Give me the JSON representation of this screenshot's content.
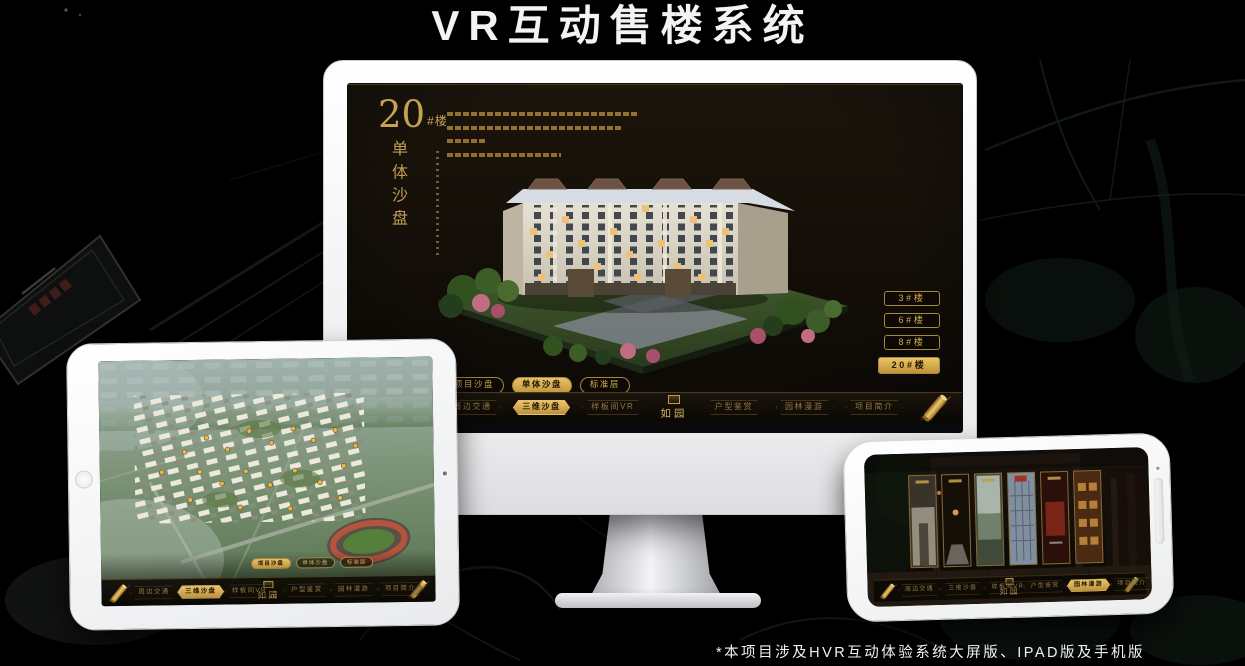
{
  "page": {
    "title": "VR互动售楼系统",
    "footnote": "*本项目涉及HVR互动体验系统大屏版、IPAD版及手机版"
  },
  "colors": {
    "gold": "#d2a94e",
    "gold_active": "#e9c268",
    "screen_background": "#171108",
    "device_white": "#ffffff"
  },
  "monitor": {
    "hero": {
      "number": "20",
      "suffix": "#楼",
      "subtitle": "单体沙盘"
    },
    "floor_buttons": [
      {
        "label": "3#楼",
        "active": false
      },
      {
        "label": "6#楼",
        "active": false
      },
      {
        "label": "8#楼",
        "active": false
      },
      {
        "label": "20#楼",
        "active": true
      }
    ],
    "tabs": [
      {
        "label": "项目沙盘",
        "active": false
      },
      {
        "label": "单体沙盘",
        "active": true
      },
      {
        "label": "标准层",
        "active": false
      }
    ],
    "nav": {
      "left": [
        {
          "label": "周边交通",
          "active": false
        },
        {
          "label": "三维沙盘",
          "active": true
        },
        {
          "label": "样板间VR",
          "active": false
        }
      ],
      "logo": "如园",
      "right": [
        {
          "label": "户型鉴赏",
          "active": false
        },
        {
          "label": "园林漫游",
          "active": false
        },
        {
          "label": "项目简介",
          "active": false
        }
      ]
    }
  },
  "tablet": {
    "tabs": [
      {
        "label": "项目沙盘",
        "active": true
      },
      {
        "label": "单体沙盘",
        "active": false
      },
      {
        "label": "标准层",
        "active": false
      }
    ],
    "nav": {
      "left": [
        {
          "label": "周边交通",
          "active": false
        },
        {
          "label": "三维沙盘",
          "active": true
        },
        {
          "label": "样板间VR",
          "active": false
        }
      ],
      "logo": "如园",
      "right": [
        {
          "label": "户型鉴赏",
          "active": false
        },
        {
          "label": "园林漫游",
          "active": false
        },
        {
          "label": "项目简介",
          "active": false
        }
      ]
    }
  },
  "phone": {
    "nav": {
      "left": [
        {
          "label": "周边交通",
          "active": false
        },
        {
          "label": "三维沙盘",
          "active": false
        },
        {
          "label": "样板间VR",
          "active": false
        }
      ],
      "logo": "如园",
      "right": [
        {
          "label": "户型鉴赏",
          "active": false
        },
        {
          "label": "园林漫游",
          "active": true
        },
        {
          "label": "项目简介",
          "active": false
        }
      ]
    }
  }
}
